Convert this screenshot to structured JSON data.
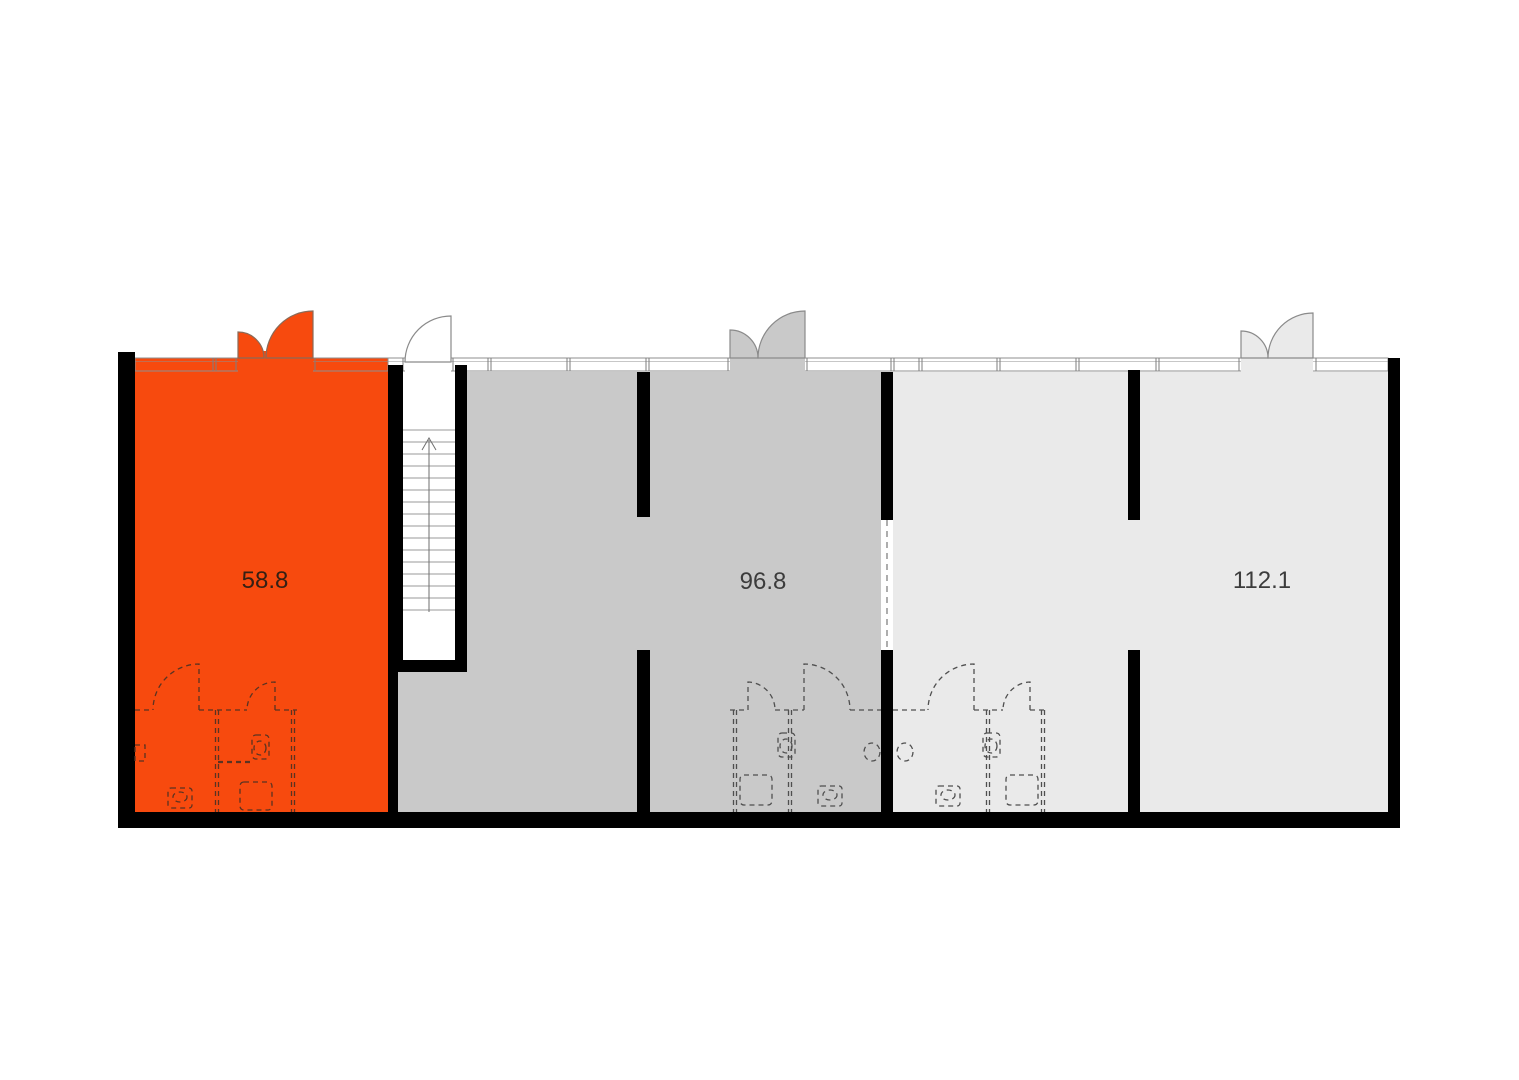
{
  "plan": {
    "title": "floor-plan",
    "background": "#ffffff",
    "wall_color": "#000000",
    "window_line_color": "#8f8f8f",
    "dashed_fixture_color": "#4f4f4f",
    "stair_line_color": "#9a9a9a",
    "units": [
      {
        "id": "unit-1",
        "area_label": "58.8",
        "fill": "#f74a0e",
        "highlighted": true,
        "label_color": "#352014"
      },
      {
        "id": "unit-2",
        "area_label": "96.8",
        "fill": "#c9c9c9",
        "highlighted": false,
        "label_color": "#3c3c3c"
      },
      {
        "id": "unit-3",
        "area_label": "112.1",
        "fill": "#eaeaea",
        "highlighted": false,
        "label_color": "#3c3c3c"
      }
    ],
    "stairs": {
      "icon": "up-arrow-icon",
      "direction": "up"
    }
  }
}
